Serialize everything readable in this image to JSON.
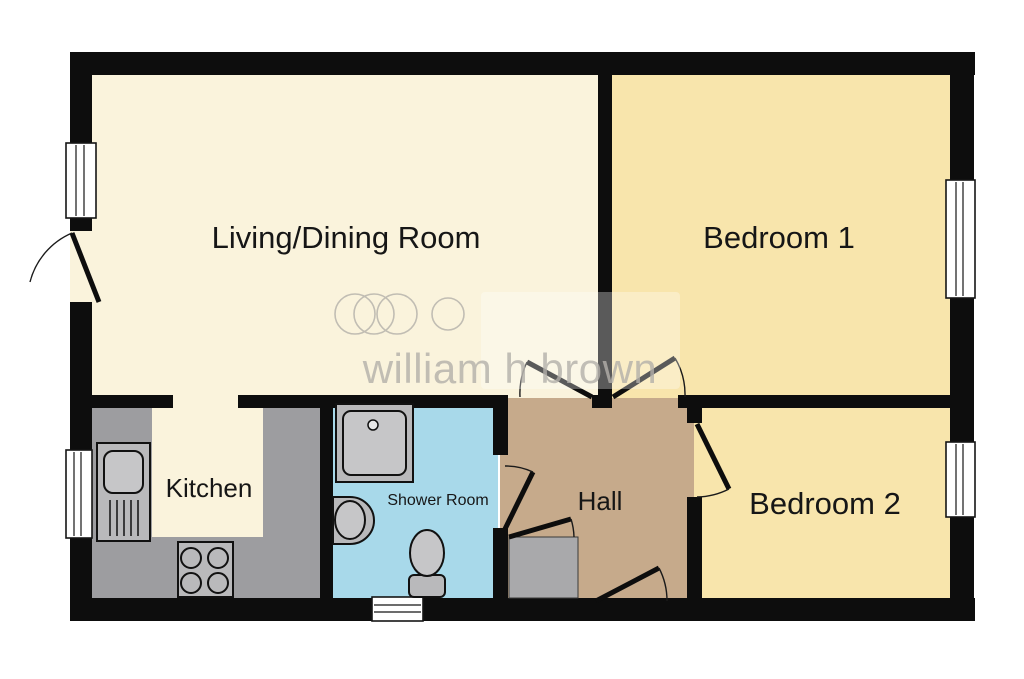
{
  "title": "Two bedroom floor plan",
  "watermark": {
    "text": "william h brown"
  },
  "colors": {
    "background": "#ffffff",
    "wall": "#0d0d0d",
    "living": "#faf3dc",
    "bedroom": "#f8e5ac",
    "hall": "#c6aa8b",
    "shower": "#a8d9ea",
    "kitchen_floor": "#faf3dc",
    "counter": "#9d9da0",
    "fixture": "#b9b9bb",
    "fixture_light": "#c6c6c8",
    "cupboard": "#a9a9ab",
    "window": "#ffffff",
    "watermark": "#b3b0aa",
    "label": "#161616"
  },
  "rooms": [
    {
      "id": "living-dining-room",
      "name": "Living/Dining Room"
    },
    {
      "id": "bedroom-1",
      "name": "Bedroom 1"
    },
    {
      "id": "bedroom-2",
      "name": "Bedroom 2"
    },
    {
      "id": "kitchen",
      "name": "Kitchen"
    },
    {
      "id": "shower-room",
      "name": "Shower Room"
    },
    {
      "id": "hall",
      "name": "Hall"
    }
  ],
  "fixtures": [
    "kitchen-sink",
    "hob",
    "shower-tray",
    "wash-basin",
    "toilet",
    "storage-cupboard"
  ]
}
